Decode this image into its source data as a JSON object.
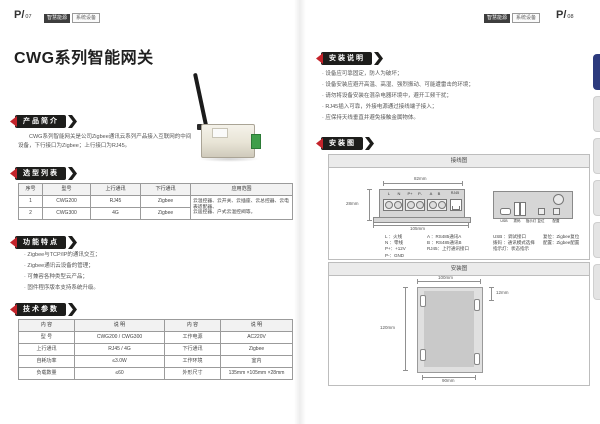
{
  "palette": {
    "ribbon_black": "#1d1d1b",
    "accent_red": "#c4242b",
    "tab_navy": "#2c3a7d"
  },
  "left": {
    "page_prefix": "P/",
    "page_no": "07",
    "badge1": "智慧能源",
    "badge2": "系统设备",
    "title": "CWG系列智能网关",
    "intro": {
      "heading": "产品简介",
      "line1": "CWG系列智能网关是公司Zigbee通讯云系列产品接入互联网的中间",
      "line2": "设备，下行接口为Zigbee；上行接口为RJ45。"
    },
    "selection": {
      "heading": "选型列表",
      "headers": [
        "序号",
        "型号",
        "上行通讯",
        "下行通讯",
        "应用范围"
      ],
      "rows": [
        [
          "1",
          "CWG200",
          "RJ45",
          "Zigbee"
        ],
        [
          "2",
          "CWG300",
          "4G",
          "Zigbee"
        ]
      ],
      "app_line1": "云温控器、云开关、云插座、云总控器、云电表适配器、",
      "app_line2": "云遥控器、户式云温控阀等。"
    },
    "features": {
      "heading": "功能特点",
      "bullets": [
        "Zigbee与TCP/IP的通讯交互；",
        "Zigbee通讯云设备的管理；",
        "可兼容各种类型云产品；",
        "固件程序版本支持系统升级。"
      ]
    },
    "tech": {
      "heading": "技术参数",
      "headers": [
        "内 容",
        "说 明",
        "内 容",
        "说 明"
      ],
      "rows": [
        [
          "型 号",
          "CWG200 / CWG300",
          "工作电源",
          "AC220V"
        ],
        [
          "上行通讯",
          "RJ45 / 4G",
          "下行通讯",
          "Zigbee"
        ],
        [
          "自耗功率",
          "≤3.0W",
          "工作环境",
          "室内"
        ],
        [
          "负载数量",
          "≤60",
          "外形尺寸",
          "135mm ×105mm ×28mm"
        ]
      ]
    }
  },
  "right": {
    "page_prefix": "P/",
    "page_no": "08",
    "badge1": "智慧能源",
    "badge2": "系统设备",
    "install": {
      "heading": "安装说明",
      "bullets": [
        "设备应可靠固定，防人为破坏；",
        "设备安装应避开高温、高湿、强烈振动、可能遭雷击的环境；",
        "请勿将设备安装在混杂电器环境中，避开工频干扰；",
        "RJ45插入可靠，外接电源通过接线端子接入；",
        "应保持天线垂直并避免接触金属物体。"
      ]
    },
    "diagram": {
      "heading": "安装图",
      "wiring": {
        "title": "接线图",
        "terminals": [
          "L",
          "N",
          "P+",
          "P-",
          "A",
          "B"
        ],
        "port": "RJ45",
        "dim_top": "82mm",
        "dim_left": "28mm",
        "dim_bottom": "105mm",
        "legend_left": [
          "L ：火线",
          "N ：零线",
          "P+：+12V",
          "P-：GND"
        ],
        "legend_right": [
          "A ：RS485通讯A",
          "B ：RS485通讯B",
          "RJ45：上行通讯接口"
        ],
        "dev2_labels": [
          "USB",
          "拨码",
          "指示灯",
          "复位",
          "配置"
        ],
        "legend2_left": [
          "USB ：调试接口",
          "拨码 ：通讯模式选择",
          "指示灯：状态指示"
        ],
        "legend2_right": [
          "复位：Zigbee复位",
          "配置：Zigbee配置"
        ]
      },
      "mounting": {
        "title": "安装图",
        "dim_top": "100mm",
        "dim_right": "12mm",
        "dim_left": "120mm",
        "dim_bottom": "90mm"
      }
    }
  }
}
